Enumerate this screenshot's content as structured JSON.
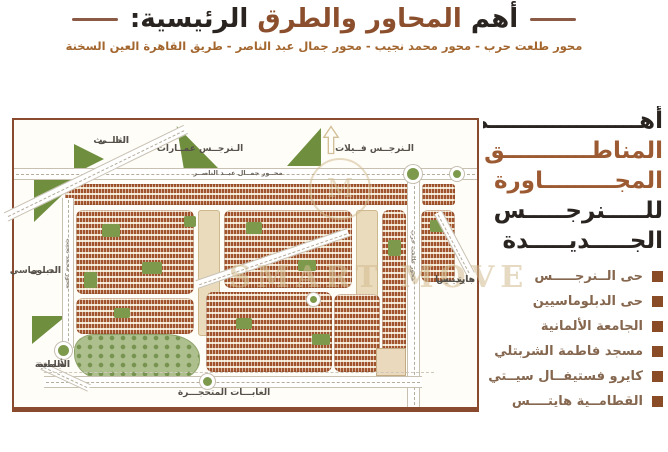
{
  "header": {
    "title_part1": "أهم",
    "title_part2": "المحاور والطرق",
    "title_part3": "الرئيسية:",
    "subtitle": "محور طلعت حرب - محور محمد نجيب - محور جمال عبد الناصر - طريق القاهرة العين السخنة"
  },
  "map": {
    "watermark": "SMART MOVE",
    "labels": {
      "third_district_l1": "الحـــى",
      "third_district_l2": "الثالـــث",
      "narges_apartments": "الـنرجــس عمــارات",
      "narges_villas": "الـنرجــس فــيلات",
      "nasser_axis": "محــور جمــال عبــد الناصــر",
      "talaat_axis": "محور طلعت حرب",
      "naguib_axis": "محور محمد نجيب",
      "diplomatic_l1": "الحـــى",
      "diplomatic_l2": "الدبلوماسي",
      "gardenia_l1": "جاردينيــا",
      "gardenia_l2": "هايتـــس",
      "german_uni_l1": "الجامعة",
      "german_uni_l2": "الألمانية",
      "petrified_forest": "الغابـــات المتحجـــرة"
    }
  },
  "aside": {
    "heading_lines": [
      "أهـــــــــــــــــــم",
      "المناطـــــــــــق",
      "المجـــــــــاورة",
      "للـــــنرجـــــس",
      "الجـــــديـــــدة"
    ],
    "items": [
      "حى الــنرجـــــس",
      "حى الدبلوماسيين",
      "الجامعة الألمانية",
      "مسجد فاطمة الشربتلي",
      "كايرو فستيفــال سيــتي",
      "القطامــية هايتــــس"
    ]
  },
  "colors": {
    "title_dark": "#2a2420",
    "title_brown": "#8c4f2e",
    "subtitle_brown": "#a3662e",
    "map_border": "#8a4a2e",
    "block_terracotta": "#a1542b",
    "green": "#7d9a4c",
    "list_text": "#85674f",
    "bullet_brown": "#8a4c26"
  }
}
